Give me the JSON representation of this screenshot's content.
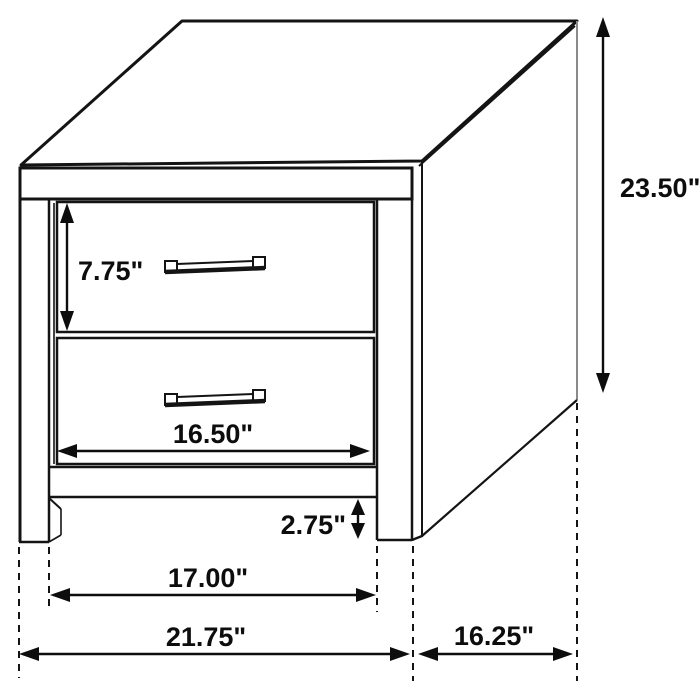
{
  "diagram": {
    "units": "inches",
    "colors": {
      "line": "#141414",
      "label": "#0d0d0d",
      "background": "#ffffff"
    },
    "dimensions": {
      "overall_height": "23.50\"",
      "top_drawer_height": "7.75\"",
      "drawer_width": "16.50\"",
      "base_clearance": "2.75\"",
      "inner_leg_span": "17.00\"",
      "overall_width": "21.75\"",
      "depth": "16.25\""
    }
  }
}
